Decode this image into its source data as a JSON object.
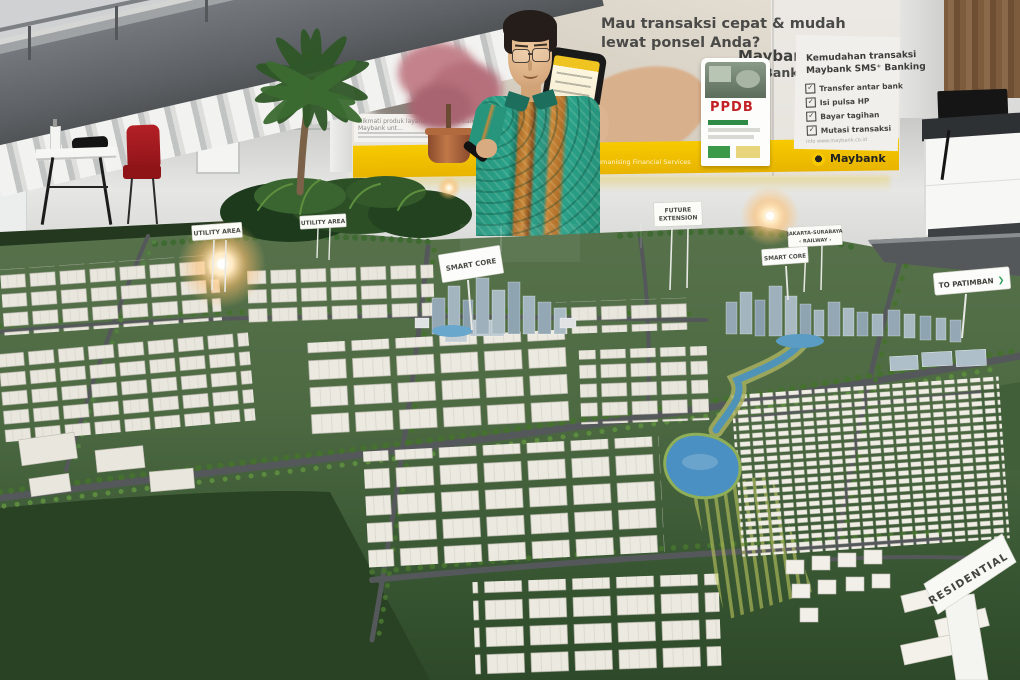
{
  "banners": {
    "left": {
      "brand": "Maybank",
      "subtitle": "Lintas …",
      "strip_text": "Nikmati produk layanan pilihan terbaik Maybank unt…"
    },
    "center": {
      "headline_1": "Mau transaksi cepat & mudah",
      "headline_2": "lewat ponsel Anda?",
      "brand": "Maybank",
      "product": "SMS⁺ Banking",
      "tagline": "Humanising Financial Services"
    },
    "right": {
      "heading_1": "Kemudahan transaksi",
      "heading_2": "Maybank SMS⁺ Banking",
      "items": [
        "Transfer antar bank",
        "Isi pulsa HP",
        "Bayar tagihan",
        "Mutasi transaksi"
      ],
      "info": "info www.maybank.co.id",
      "brand": "Maybank"
    },
    "rollup": {
      "title": "PPDB"
    }
  },
  "model_signs": {
    "utility_area": "UTILITY AREA",
    "future_extension_1": "FUTURE",
    "future_extension_2": "EXTENSION",
    "smart_core": "SMART CORE",
    "railway_1": "JAKARTA-SURABAYA",
    "railway_2": "‹ RAILWAY ›",
    "to_patimban": "TO PATIMBAN",
    "to_patimban_arrow": "❯",
    "residential": "RESIDENTIAL"
  },
  "icons": {
    "check": "✓"
  },
  "colors": {
    "banner_yellow": "#f2c400",
    "ppdb_red": "#c22024",
    "model_green": "#4d6a43",
    "field_dark_green": "#2a4224",
    "lake_blue": "#4a90c2",
    "road_gray": "#55585a",
    "building_white": "#e9e6dd",
    "tower_blue_gray": "#9bafbb",
    "tree_green": "#45702f",
    "batik_teal": "#2aa189",
    "batik_orange": "#c8883a",
    "chair_red": "#a3191f",
    "lamp_glow": "#ffd9a0"
  }
}
